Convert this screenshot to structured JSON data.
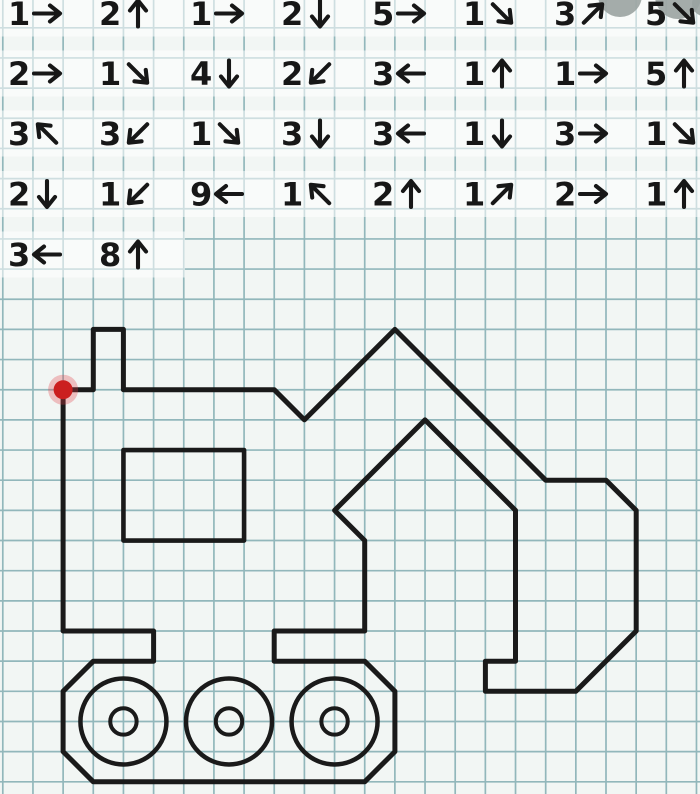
{
  "worksheet": {
    "kind_label": "graphic-dictation-grid-worksheet",
    "canvas": {
      "width": 700,
      "height": 794
    },
    "grid": {
      "cell": 30.16,
      "origin_x": 2.8,
      "origin_y": 27.8,
      "cols": 24,
      "rows": 26,
      "line_color": "#8db4b8",
      "paper_color": "#f2f6f4"
    },
    "instructions": {
      "text_color": "#171717",
      "rows": [
        [
          {
            "n": "1",
            "dir": "→"
          },
          {
            "n": "2",
            "dir": "↑"
          },
          {
            "n": "1",
            "dir": "→"
          },
          {
            "n": "2",
            "dir": "↓"
          },
          {
            "n": "5",
            "dir": "→"
          },
          {
            "n": "1",
            "dir": "↘"
          },
          {
            "n": "3",
            "dir": "↗"
          },
          {
            "n": "5",
            "dir": "↘"
          }
        ],
        [
          {
            "n": "2",
            "dir": "→"
          },
          {
            "n": "1",
            "dir": "↘"
          },
          {
            "n": "4",
            "dir": "↓"
          },
          {
            "n": "2",
            "dir": "↙"
          },
          {
            "n": "3",
            "dir": "←"
          },
          {
            "n": "1",
            "dir": "↑"
          },
          {
            "n": "1",
            "dir": "→"
          },
          {
            "n": "5",
            "dir": "↑"
          }
        ],
        [
          {
            "n": "3",
            "dir": "↖"
          },
          {
            "n": "3",
            "dir": "↙"
          },
          {
            "n": "1",
            "dir": "↘"
          },
          {
            "n": "3",
            "dir": "↓"
          },
          {
            "n": "3",
            "dir": "←"
          },
          {
            "n": "1",
            "dir": "↓"
          },
          {
            "n": "3",
            "dir": "→"
          },
          {
            "n": "1",
            "dir": "↘"
          }
        ],
        [
          {
            "n": "2",
            "dir": "↓"
          },
          {
            "n": "1",
            "dir": "↙"
          },
          {
            "n": "9",
            "dir": "←"
          },
          {
            "n": "1",
            "dir": "↖"
          },
          {
            "n": "2",
            "dir": "↑"
          },
          {
            "n": "1",
            "dir": "↗"
          },
          {
            "n": "2",
            "dir": "→"
          },
          {
            "n": "1",
            "dir": "↑"
          }
        ],
        [
          {
            "n": "3",
            "dir": "←"
          },
          {
            "n": "8",
            "dir": "↑"
          }
        ]
      ],
      "row_centers_y": [
        13.5,
        73.5,
        133.5,
        194,
        254.5
      ],
      "slot_x0": 8,
      "slot_step": 91,
      "arrow_offset_x": 39,
      "highlight_color": "rgba(255,255,255,0.55)",
      "row5_highlight_width": 185
    },
    "figure": {
      "name": "excavator-outline",
      "stroke_color": "#1a1a1a",
      "stroke_width": 5,
      "start_cell": [
        2,
        12
      ],
      "outline_follows_instructions": true,
      "window_cells": {
        "x": 4,
        "y": 14,
        "w": 4,
        "h": 3
      },
      "wheels": {
        "row": 23,
        "cols": [
          4,
          7.5,
          11
        ],
        "outer_radius_px": 43,
        "inner_radius_px": 13.2,
        "stroke_width": 4.5
      },
      "start_dot": {
        "cell": [
          2,
          12
        ],
        "core_color": "#cb1f1f",
        "glow_color": "rgba(225,60,70,0.30)",
        "core_radius": 9.5,
        "glow_radius": 15
      }
    },
    "watermark": {
      "color": "#9aa3a1",
      "circles": [
        {
          "cx": 620,
          "cy": -5,
          "r": 22
        },
        {
          "cx": 678,
          "cy": -4,
          "r": 23
        },
        {
          "cx": 704,
          "cy": 4,
          "r": 12
        }
      ]
    }
  }
}
